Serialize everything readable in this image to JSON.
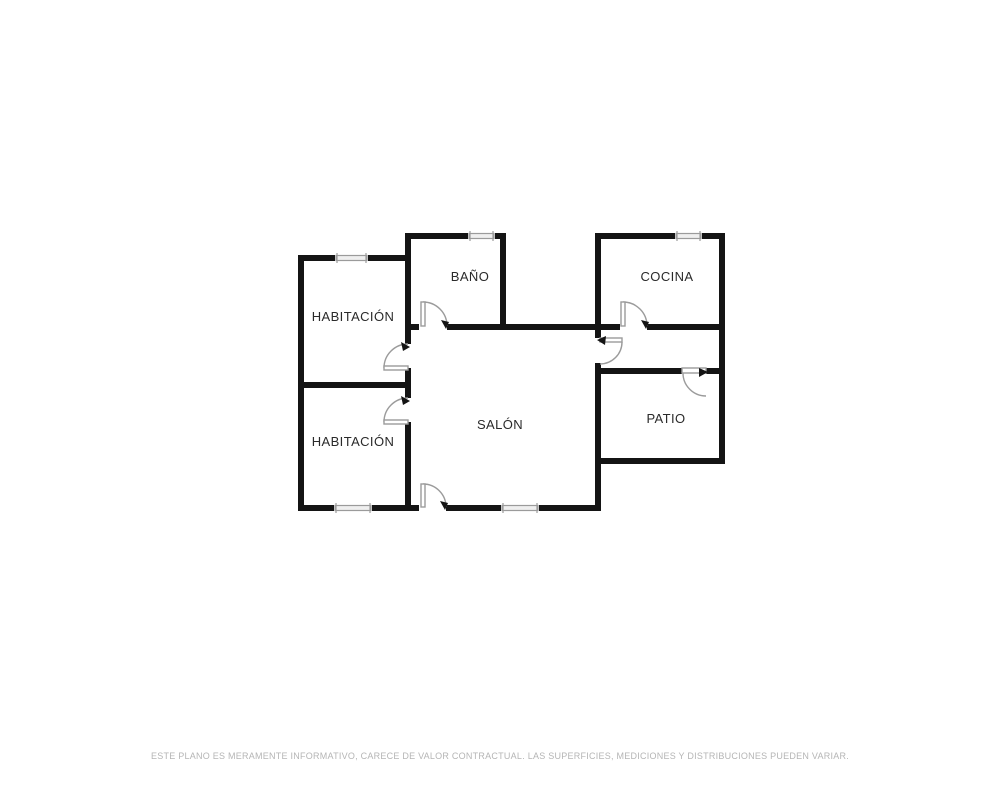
{
  "plan": {
    "rooms": [
      {
        "id": "habitacion-1",
        "label": "HABITACIÓN"
      },
      {
        "id": "bano",
        "label": "BAÑO"
      },
      {
        "id": "cocina",
        "label": "COCINA"
      },
      {
        "id": "salon",
        "label": "SALÓN"
      },
      {
        "id": "habitacion-2",
        "label": "HABITACIÓN"
      },
      {
        "id": "patio",
        "label": "PATIO"
      }
    ],
    "colors": {
      "wall": "#141414",
      "door_arc": "#9b9b9b",
      "window_fill": "#efefef",
      "window_stroke": "#9b9b9b",
      "label": "#2a2a2a",
      "disclaimer": "#b5b5b5"
    }
  },
  "footer": {
    "disclaimer": "ESTE PLANO ES MERAMENTE INFORMATIVO, CARECE DE VALOR CONTRACTUAL. LAS SUPERFICIES, MEDICIONES Y DISTRIBUCIONES PUEDEN VARIAR."
  }
}
